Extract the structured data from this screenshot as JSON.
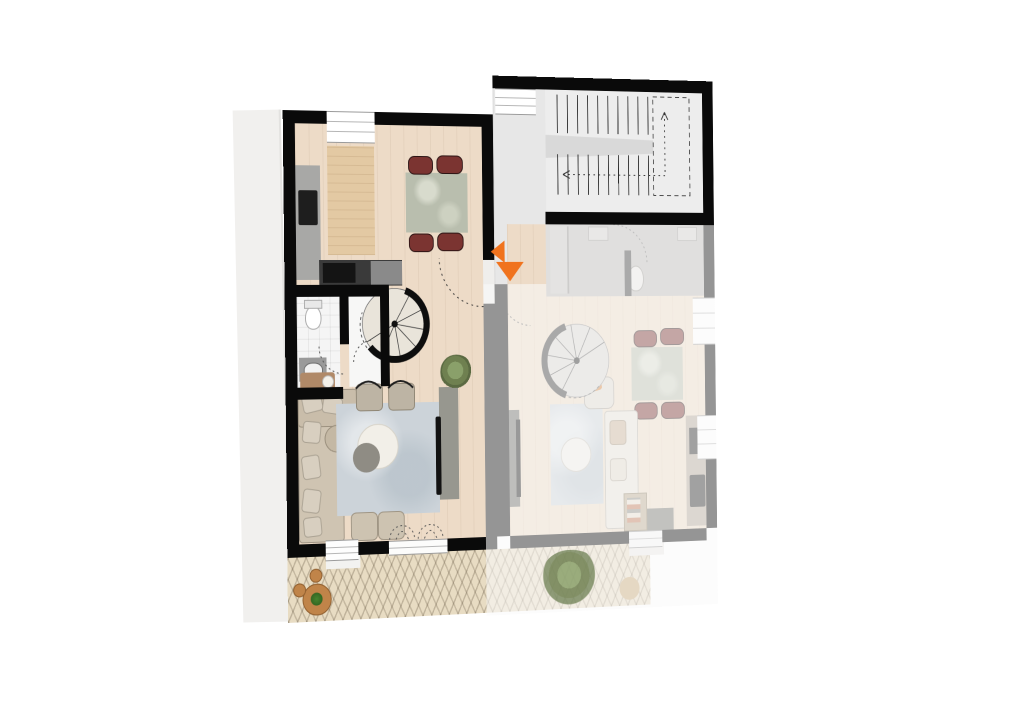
{
  "scene": {
    "type": "architectural-floor-plan-top-view",
    "background": "#ffffff",
    "units_shown": 2,
    "highlight_state": {
      "left_unit": "active",
      "right_unit": "dimmed"
    }
  },
  "palette": {
    "wall": "#0a0a0a",
    "wood_floor": "#eddbc7",
    "bathroom_tile": "#f5f5f5",
    "stairwell_floor": "#ededed",
    "entry_wall_band": "#e7e7e7",
    "corridor_floor": "#bdbbb8",
    "terrace_paving": "#e8dcc3",
    "rug": "#ccd3d9",
    "sofa": "#cfc4b2",
    "dining_chair": "#7b3431",
    "dining_table_marble": "#b9beae",
    "kitchen_counter": "#a8a8a6",
    "appliance_dark": "#1e1e1e",
    "tv_cabinet": "#97978f",
    "plant_green": "#7e8f5e",
    "accent_orange": "#f0731e",
    "dim_overlay": "rgba(250,250,249,0.58)"
  },
  "marker": {
    "name": "entrance-marker",
    "color": "#f0731e",
    "arrows": [
      "left",
      "down"
    ]
  },
  "left_apartment": {
    "state": "active",
    "rooms": [
      "kitchen-dining",
      "bathroom",
      "walk-in-closet",
      "living-room"
    ],
    "furniture": [
      "kitchen-counter-with-sink",
      "cooktop",
      "fridge",
      "tall-cabinet",
      "dining-table",
      "dining-chairs-x4",
      "spiral-staircase",
      "toilet",
      "bathroom-sink",
      "l-shaped-sofa",
      "side-table",
      "armchairs-x2",
      "area-rug",
      "coffee-tables-x2",
      "poufs-x2",
      "tv-cabinet",
      "tv",
      "potted-plant",
      "french-doors",
      "patio-shrubs-x2"
    ]
  },
  "right_apartment": {
    "state": "dimmed",
    "mirrored": true,
    "rooms": [
      "bathroom",
      "kitchen-dining",
      "living-room"
    ],
    "furniture": [
      "shower",
      "wall-sinks-x2",
      "toilet",
      "spiral-staircase",
      "dining-table",
      "dining-chairs-x4",
      "kitchen-counter-with-sink",
      "sofa",
      "armchair-with-orange-throw",
      "area-rug",
      "coffee-table",
      "tv",
      "shelf",
      "terrace-door"
    ]
  },
  "stairwell": {
    "type": "communal-staircase",
    "flights": 2,
    "landing": "dashed-outline"
  },
  "terrace": {
    "paving": "herringbone",
    "left_half": "active",
    "right_half": "dimmed",
    "items": [
      "bistro-table-with-plant",
      "stools-x2",
      "bush",
      "dimmed-table"
    ]
  },
  "surroundings": {
    "left_strip": "adjacent-building-edge"
  }
}
